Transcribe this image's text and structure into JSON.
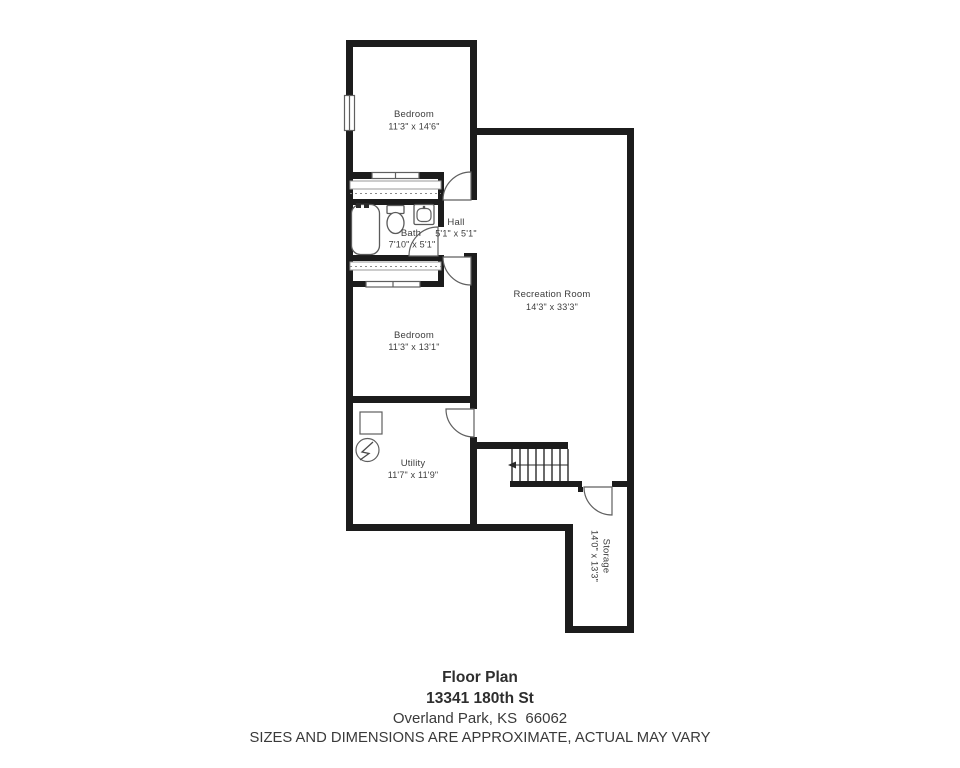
{
  "rooms": [
    {
      "id": "bedroom-1",
      "name": "Bedroom",
      "dims": "11'3\" x 14'6\""
    },
    {
      "id": "bath",
      "name": "Bath",
      "dims": "7'10\" x 5'1\""
    },
    {
      "id": "hall",
      "name": "Hall",
      "dims": "5'1\" x 5'1\""
    },
    {
      "id": "recreation-room",
      "name": "Recreation Room",
      "dims": "14'3\" x 33'3\""
    },
    {
      "id": "bedroom-2",
      "name": "Bedroom",
      "dims": "11'3\" x 13'1\""
    },
    {
      "id": "utility",
      "name": "Utility",
      "dims": "11'7\" x 11'9\""
    },
    {
      "id": "storage",
      "name": "Storage",
      "dims": "14'0\" x 13'3\""
    }
  ],
  "footer": {
    "title": "Floor Plan",
    "address_line1": "13341 180th St",
    "address_line2": "Overland Park, KS  66062",
    "disclaimer": "SIZES AND DIMENSIONS ARE APPROXIMATE, ACTUAL MAY VARY"
  },
  "colors": {
    "wall": "#1c1c1c",
    "line": "#5f5f5f",
    "text": "#3d3d3d",
    "background": "#ffffff"
  }
}
